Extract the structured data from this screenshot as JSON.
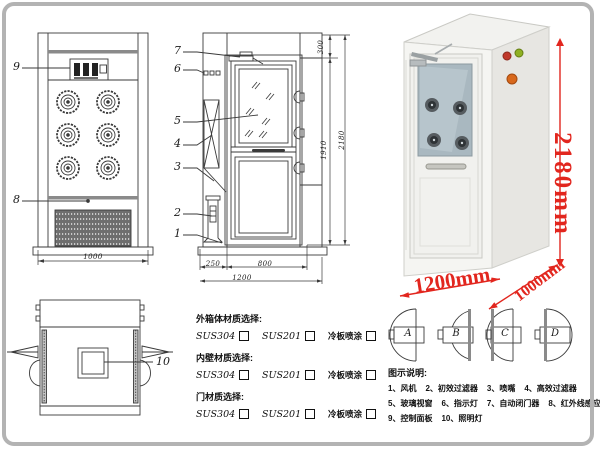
{
  "colors": {
    "dimension_red": "#e2261e",
    "line_ink": "#3a3a3a"
  },
  "front_view": {
    "callout_control_panel": "9",
    "callout_grille": "8",
    "width_dim": "1000"
  },
  "side_view": {
    "callouts": {
      "c7": "7",
      "c6": "6",
      "c5": "5",
      "c4": "4",
      "c3": "3",
      "c2": "2",
      "c1": "1"
    },
    "dims": {
      "top_section": "300",
      "door_height": "1910",
      "total_height": "2180",
      "side_width": "250",
      "door_width": "800",
      "total_width": "1200"
    }
  },
  "plan_view": {
    "callout_light": "10"
  },
  "photo": {
    "height": "2180mm",
    "width": "1200mm",
    "depth": "1000mm"
  },
  "door_options": {
    "a": "A",
    "b": "B",
    "c": "C",
    "d": "D"
  },
  "materials": {
    "groups": [
      {
        "label": "外箱体材质选择:",
        "options": [
          "SUS304",
          "SUS201",
          "冷板喷涂"
        ]
      },
      {
        "label": "内壁材质选择:",
        "options": [
          "SUS304",
          "SUS201",
          "冷板喷涂"
        ]
      },
      {
        "label": "门材质选择:",
        "options": [
          "SUS304",
          "SUS201",
          "冷板喷涂"
        ]
      }
    ]
  },
  "legend": {
    "title": "图示说明:",
    "rows": [
      [
        "1、风机",
        "2、初效过滤器",
        "3、喷嘴",
        "4、高效过滤器"
      ],
      [
        "5、玻璃视窗",
        "6、指示灯",
        "7、自动闭门器",
        "8、红外线感应器"
      ],
      [
        "9、控制面板",
        "10、照明灯"
      ]
    ]
  }
}
